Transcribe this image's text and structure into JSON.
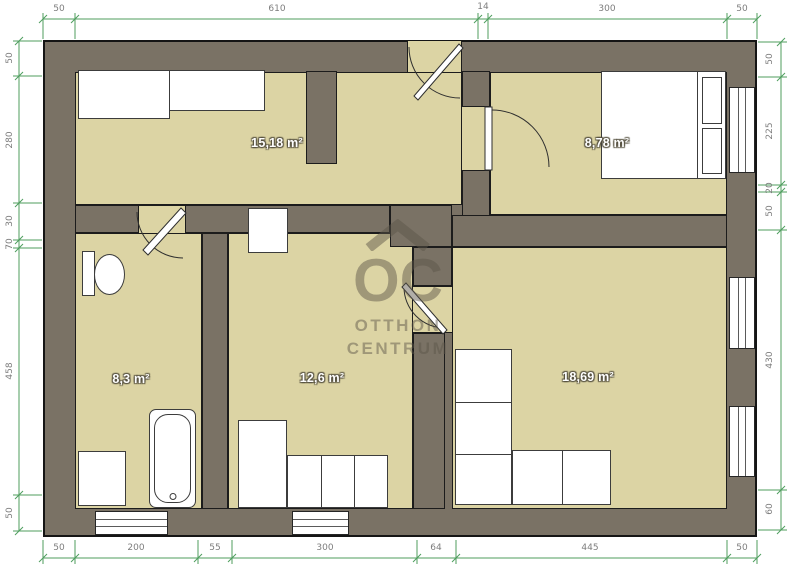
{
  "watermark": {
    "logo": "OC",
    "name_line1": "OTTHON",
    "name_line2": "CENTRUM"
  },
  "rooms": [
    {
      "name": "living-room-top-left",
      "area": "15,18 m²"
    },
    {
      "name": "bedroom-top-right",
      "area": "8,78 m²"
    },
    {
      "name": "bathroom-bottom-left",
      "area": "8,3 m²"
    },
    {
      "name": "room-bottom-middle",
      "area": "12,6 m²"
    },
    {
      "name": "room-bottom-right",
      "area": "18,69 m²"
    }
  ],
  "dimensions": {
    "top": [
      "50",
      "610",
      "14",
      "300",
      "50"
    ],
    "bottom": [
      "50",
      "200",
      "55",
      "300",
      "64",
      "445",
      "50"
    ],
    "left": [
      "50",
      "280",
      "30",
      "70",
      "458",
      "50"
    ],
    "right": [
      "50",
      "225",
      "20",
      "50",
      "430",
      "60"
    ]
  },
  "colors": {
    "wall": "#7a7265",
    "floor": "#dcd4a4",
    "dimension_line": "#4f9e5e",
    "dimension_text": "#7d7d7d",
    "furniture": "#ffffff",
    "outline": "#1c1c1c",
    "watermark": "rgba(92,85,73,0.48)"
  }
}
